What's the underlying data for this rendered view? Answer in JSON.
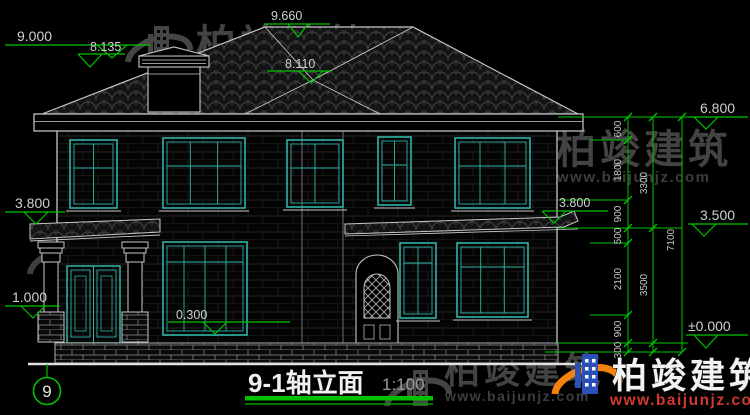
{
  "drawing": {
    "title_block": {
      "title": "9-1轴立面",
      "scale": "1:100"
    },
    "axis": {
      "label": "9"
    },
    "elevations": {
      "chimney_top": "9.000",
      "ridge": "9.660",
      "roof_left": "8.135",
      "roof_inner": "8.110",
      "main_eave": "6.800",
      "porch_roof": "3.800",
      "awning": "3.800",
      "second_floor": "3.500",
      "pedestal": "1.000",
      "sill": "0.300",
      "ground": "±0.000"
    },
    "dimensions": {
      "inner_chain": [
        "600",
        "1800",
        "900",
        "500",
        "2100",
        "900",
        "300"
      ],
      "mid_chain": [
        "3300",
        "3500"
      ],
      "total": "7100"
    }
  },
  "watermark": {
    "brand": "柏竣建筑",
    "url": "www.baijunjz.com"
  },
  "colors": {
    "dim_green": "#00c300",
    "window_teal": "#2fb3a9",
    "line_white": "#cdcdcd",
    "wm_gray": "#828282",
    "logo_orange": "#f5820a",
    "logo_blue": "#2b50b8",
    "url_red": "#d03a30"
  }
}
